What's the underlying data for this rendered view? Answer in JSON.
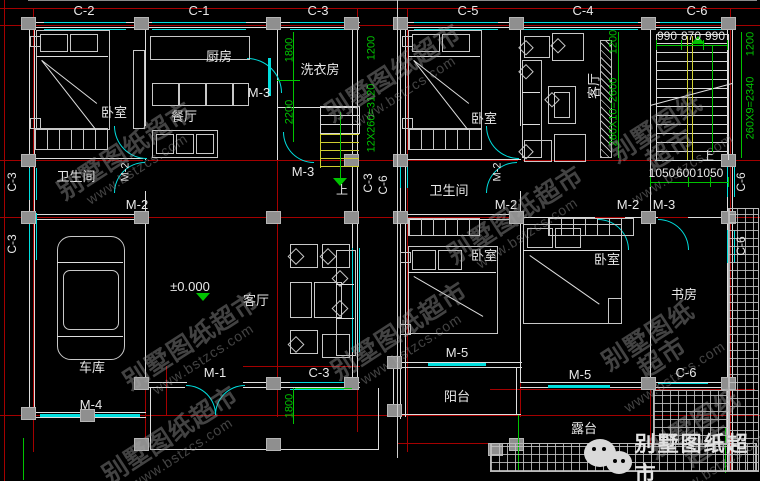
{
  "colors": {
    "grid_red": "#a40000",
    "dim_green": "#00c400",
    "window_cyan": "#00dede",
    "wall_white": "#dedede",
    "stair_yellow": "#cfcf30",
    "column_gray": "#8f8f8f"
  },
  "logo": {
    "text": "别墅图纸超市",
    "icon": "wechat-icon"
  },
  "watermark": {
    "line1": "别墅图纸超市",
    "line2": "www.bstzcs.com",
    "positions": [
      [
        130,
        158
      ],
      [
        398,
        80
      ],
      [
        668,
        146
      ],
      [
        196,
        348
      ],
      [
        404,
        338
      ],
      [
        660,
        354
      ],
      [
        520,
        222
      ],
      [
        175,
        442
      ],
      [
        706,
        442
      ]
    ]
  },
  "elevation_marker": "±0.000",
  "texts": [
    {
      "n": "axis-label-c2",
      "t": "C-2",
      "x": 84,
      "y": 4
    },
    {
      "n": "axis-label-c1",
      "t": "C-1",
      "x": 199,
      "y": 4
    },
    {
      "n": "axis-label-c3-top",
      "t": "C-3",
      "x": 318,
      "y": 4
    },
    {
      "n": "axis-label-c5",
      "t": "C-5",
      "x": 468,
      "y": 4
    },
    {
      "n": "axis-label-c4",
      "t": "C-4",
      "x": 583,
      "y": 4
    },
    {
      "n": "axis-label-c6-top",
      "t": "C-6",
      "x": 697,
      "y": 4
    },
    {
      "n": "room-label-kitchen",
      "t": "厨房",
      "x": 219,
      "y": 50
    },
    {
      "n": "room-label-laundry",
      "t": "洗衣房",
      "x": 320,
      "y": 63
    },
    {
      "n": "door-label-m3-kitchen",
      "t": "M-3",
      "x": 259,
      "y": 86
    },
    {
      "n": "room-label-bedroom-l1",
      "t": "卧室",
      "x": 114,
      "y": 106
    },
    {
      "n": "room-label-dining",
      "t": "餐厅",
      "x": 184,
      "y": 110
    },
    {
      "n": "dim-1800-left",
      "t": "1800",
      "x": 290,
      "y": 50,
      "r": 1,
      "c": "g"
    },
    {
      "n": "dim-2200-left",
      "t": "2200",
      "x": 290,
      "y": 112,
      "r": 1,
      "c": "g"
    },
    {
      "n": "room-label-bath-l",
      "t": "卫生间",
      "x": 76,
      "y": 170
    },
    {
      "n": "door-label-m2-l-rot",
      "t": "M-2",
      "x": 126,
      "y": 172,
      "r": 1,
      "s": 11
    },
    {
      "n": "door-label-m2-l",
      "t": "M-2",
      "x": 137,
      "y": 198
    },
    {
      "n": "door-label-m3-stairs",
      "t": "M-3",
      "x": 303,
      "y": 165
    },
    {
      "n": "stair-up-left",
      "t": "上",
      "x": 342,
      "y": 184,
      "s": 12
    },
    {
      "n": "dim-1200-mid",
      "t": "1200",
      "x": 372,
      "y": 48,
      "r": 1,
      "c": "g"
    },
    {
      "n": "dim-stair-left",
      "t": "12X260=3120",
      "x": 372,
      "y": 118,
      "r": 1,
      "c": "g"
    },
    {
      "n": "axis-label-c3-left-a",
      "t": "C-3",
      "x": 12,
      "y": 182,
      "r": 1,
      "s": 12
    },
    {
      "n": "axis-label-c3-left-b",
      "t": "C-3",
      "x": 12,
      "y": 244,
      "r": 1,
      "s": 12
    },
    {
      "n": "axis-label-c3-mid",
      "t": "C-3",
      "x": 368,
      "y": 183,
      "r": 1,
      "s": 12
    },
    {
      "n": "axis-label-c6-mid",
      "t": "C-6",
      "x": 383,
      "y": 185,
      "r": 1,
      "s": 12
    },
    {
      "n": "elevation-label",
      "t": "±0.000",
      "x": 190,
      "y": 280
    },
    {
      "n": "room-label-living-l",
      "t": "客厅",
      "x": 256,
      "y": 294
    },
    {
      "n": "room-label-garage",
      "t": "车库",
      "x": 92,
      "y": 361
    },
    {
      "n": "door-label-m4",
      "t": "M-4",
      "x": 91,
      "y": 398
    },
    {
      "n": "door-label-m1",
      "t": "M-1",
      "x": 215,
      "y": 366
    },
    {
      "n": "window-label-c3-bottom",
      "t": "C-3",
      "x": 319,
      "y": 366
    },
    {
      "n": "dim-1800-bottom",
      "t": "1800",
      "x": 290,
      "y": 406,
      "r": 1,
      "c": "g"
    },
    {
      "n": "room-label-bedroom-r1",
      "t": "卧室",
      "x": 484,
      "y": 112
    },
    {
      "n": "room-label-living-r",
      "t": "客厅",
      "x": 594,
      "y": 86,
      "r": 1
    },
    {
      "n": "dim-1200-r1",
      "t": "1200",
      "x": 614,
      "y": 42,
      "r": 1,
      "c": "g"
    },
    {
      "n": "dim-stair-r1",
      "t": "260X10=2600",
      "x": 614,
      "y": 112,
      "r": 1,
      "c": "g"
    },
    {
      "n": "dim-990-a",
      "t": "990",
      "x": 667,
      "y": 30,
      "s": 12
    },
    {
      "n": "dim-870",
      "t": "870",
      "x": 691,
      "y": 30,
      "s": 12
    },
    {
      "n": "dim-990-b",
      "t": "990",
      "x": 715,
      "y": 30,
      "s": 12
    },
    {
      "n": "dim-1200-r2",
      "t": "1200",
      "x": 751,
      "y": 44,
      "r": 1,
      "c": "g"
    },
    {
      "n": "dim-stair-r2",
      "t": "260X9=2340",
      "x": 751,
      "y": 108,
      "r": 1,
      "c": "g"
    },
    {
      "n": "room-label-bath-r",
      "t": "卫生间",
      "x": 449,
      "y": 184
    },
    {
      "n": "door-label-m2-r-rot",
      "t": "M-2",
      "x": 498,
      "y": 172,
      "r": 1,
      "s": 11
    },
    {
      "n": "door-label-m2-r1",
      "t": "M-2",
      "x": 506,
      "y": 198
    },
    {
      "n": "door-label-m2-r2",
      "t": "M-2",
      "x": 628,
      "y": 198
    },
    {
      "n": "door-label-m3-r",
      "t": "M-3",
      "x": 664,
      "y": 198
    },
    {
      "n": "stair-up-right",
      "t": "上",
      "x": 708,
      "y": 150,
      "s": 12
    },
    {
      "n": "dim-1050-a",
      "t": "1050",
      "x": 662,
      "y": 167,
      "s": 12
    },
    {
      "n": "dim-600",
      "t": "600",
      "x": 686,
      "y": 167,
      "s": 12
    },
    {
      "n": "dim-1050-b",
      "t": "1050",
      "x": 710,
      "y": 167,
      "s": 12
    },
    {
      "n": "axis-label-c6-right-a",
      "t": "C-6",
      "x": 741,
      "y": 182,
      "r": 1,
      "s": 12
    },
    {
      "n": "axis-label-c6-right-b",
      "t": "C-6",
      "x": 741,
      "y": 246,
      "r": 1,
      "s": 12
    },
    {
      "n": "room-label-bedroom-r2",
      "t": "卧室",
      "x": 484,
      "y": 249
    },
    {
      "n": "room-label-bedroom-r3",
      "t": "卧室",
      "x": 607,
      "y": 253
    },
    {
      "n": "room-label-study",
      "t": "书房",
      "x": 684,
      "y": 288
    },
    {
      "n": "door-label-m5-a",
      "t": "M-5",
      "x": 457,
      "y": 346
    },
    {
      "n": "room-label-balcony",
      "t": "阳台",
      "x": 457,
      "y": 390
    },
    {
      "n": "door-label-m5-b",
      "t": "M-5",
      "x": 580,
      "y": 368
    },
    {
      "n": "window-label-c6-bottom",
      "t": "C-6",
      "x": 686,
      "y": 366
    },
    {
      "n": "room-label-terrace",
      "t": "露台",
      "x": 584,
      "y": 422
    }
  ]
}
